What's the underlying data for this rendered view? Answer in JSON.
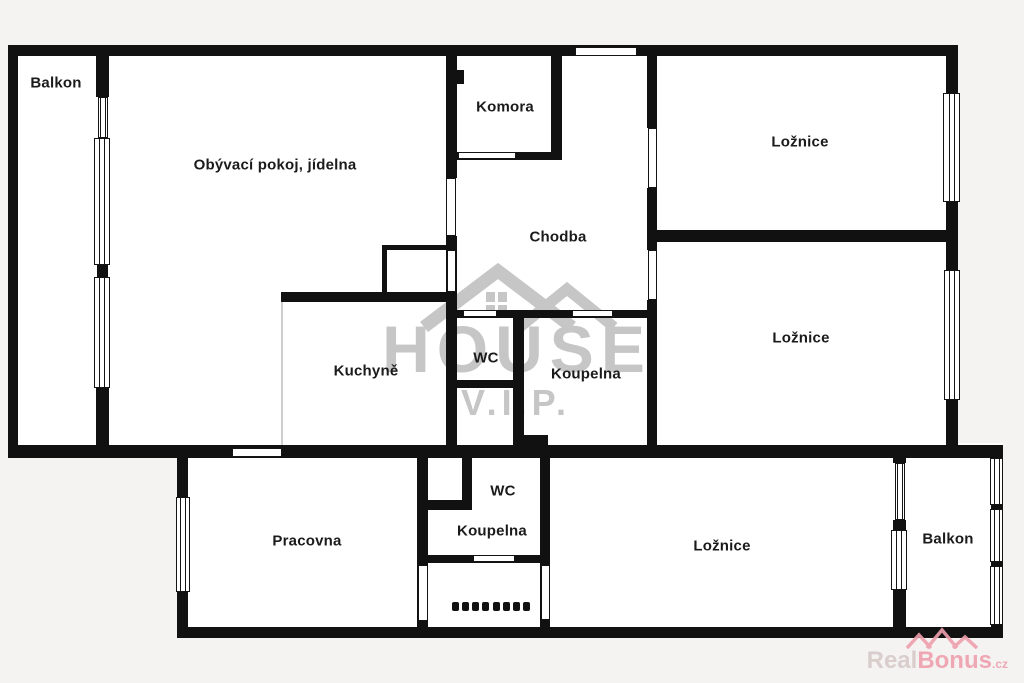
{
  "floorplan": {
    "rooms": {
      "balkon_top": {
        "label": "Balkon"
      },
      "obyvaci": {
        "label": "Obývací pokoj, jídelna"
      },
      "komora": {
        "label": "Komora"
      },
      "loznice_top": {
        "label": "Ložnice"
      },
      "chodba": {
        "label": "Chodba"
      },
      "loznice_mid": {
        "label": "Ložnice"
      },
      "kuchyne": {
        "label": "Kuchyně"
      },
      "wc_upper": {
        "label": "WC"
      },
      "koupelna_upper": {
        "label": "Koupelna"
      },
      "pracovna": {
        "label": "Pracovna"
      },
      "wc_lower": {
        "label": "WC"
      },
      "koupelna_lower": {
        "label": "Koupelna"
      },
      "loznice_bottom": {
        "label": "Ložnice"
      },
      "balkon_bottom": {
        "label": "Balkon"
      }
    },
    "watermark": {
      "line1": "HOUSE",
      "line2": "V.I.P.",
      "color": "#c6c6c6"
    },
    "logo": {
      "part1": "Real",
      "part2": "Bonus",
      "suffix": ".cz",
      "color_accent": "#ee9fad",
      "color_muted": "#d8caca"
    },
    "colors": {
      "wall": "#111111",
      "floor": "#ffffff",
      "background": "#f4f3f2"
    }
  }
}
